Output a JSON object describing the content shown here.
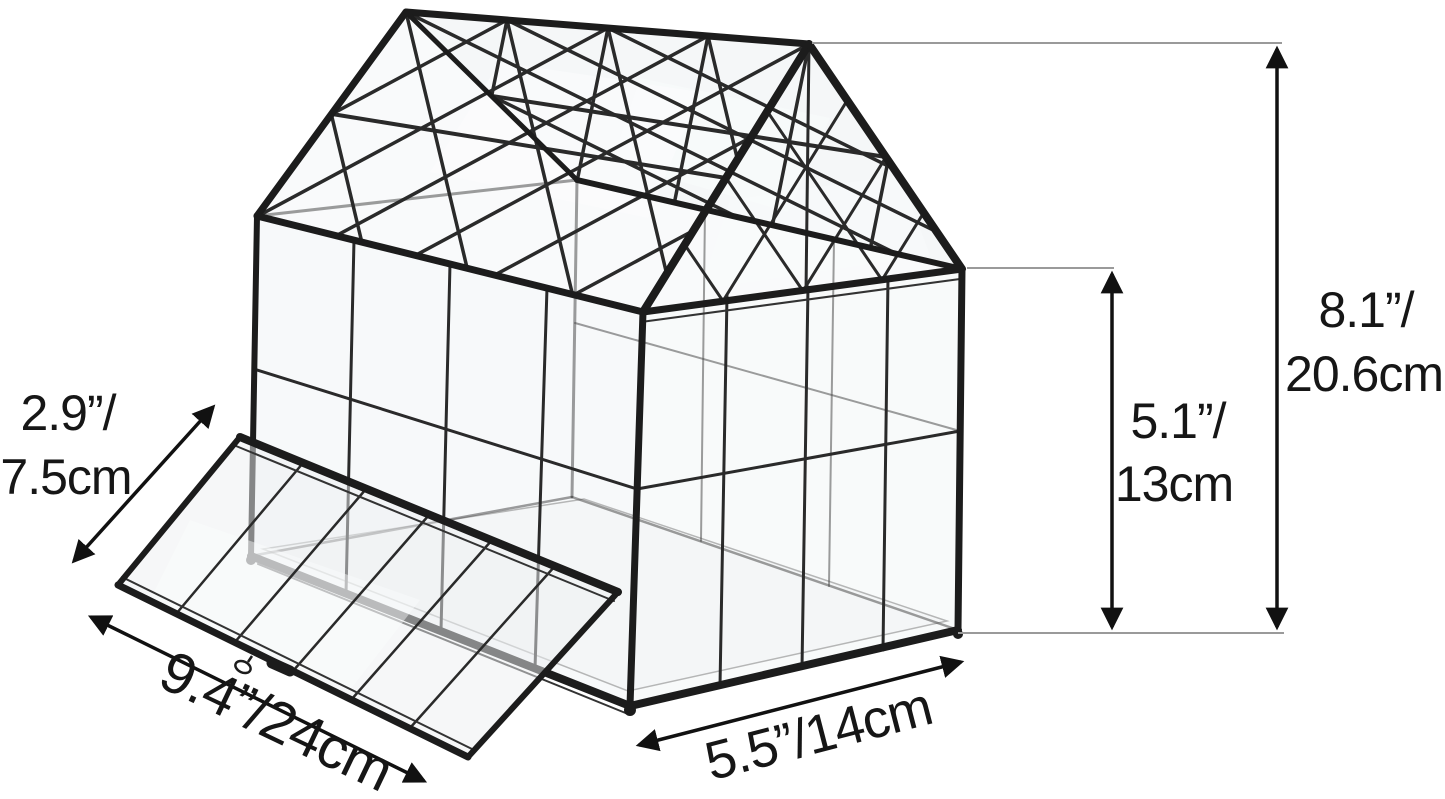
{
  "page": {
    "background": "#ffffff",
    "width_px": 1445,
    "height_px": 799
  },
  "product": {
    "name": "glass-house-terrarium",
    "frame_color": "#1c1c1c",
    "glass_tint": "#e9edef",
    "connector_line_color": "#9a9a9a",
    "label_text_color": "#161616"
  },
  "measurements": {
    "door_short_side": {
      "line1": "2.9”/",
      "line2": "7.5cm",
      "value": "2.9 in / 7.5 cm"
    },
    "door_long_side": {
      "label": "9.4”/24cm",
      "value": "9.4 in / 24 cm"
    },
    "base_front_width": {
      "label": "5.5”/14cm",
      "value": "5.5 in / 14 cm"
    },
    "wall_height": {
      "line1": "5.1”/",
      "line2": "13cm",
      "value": "5.1 in / 13 cm"
    },
    "overall_height": {
      "line1": "8.1”/",
      "line2": "20.6cm",
      "value": "8.1 in / 20.6 cm"
    }
  }
}
